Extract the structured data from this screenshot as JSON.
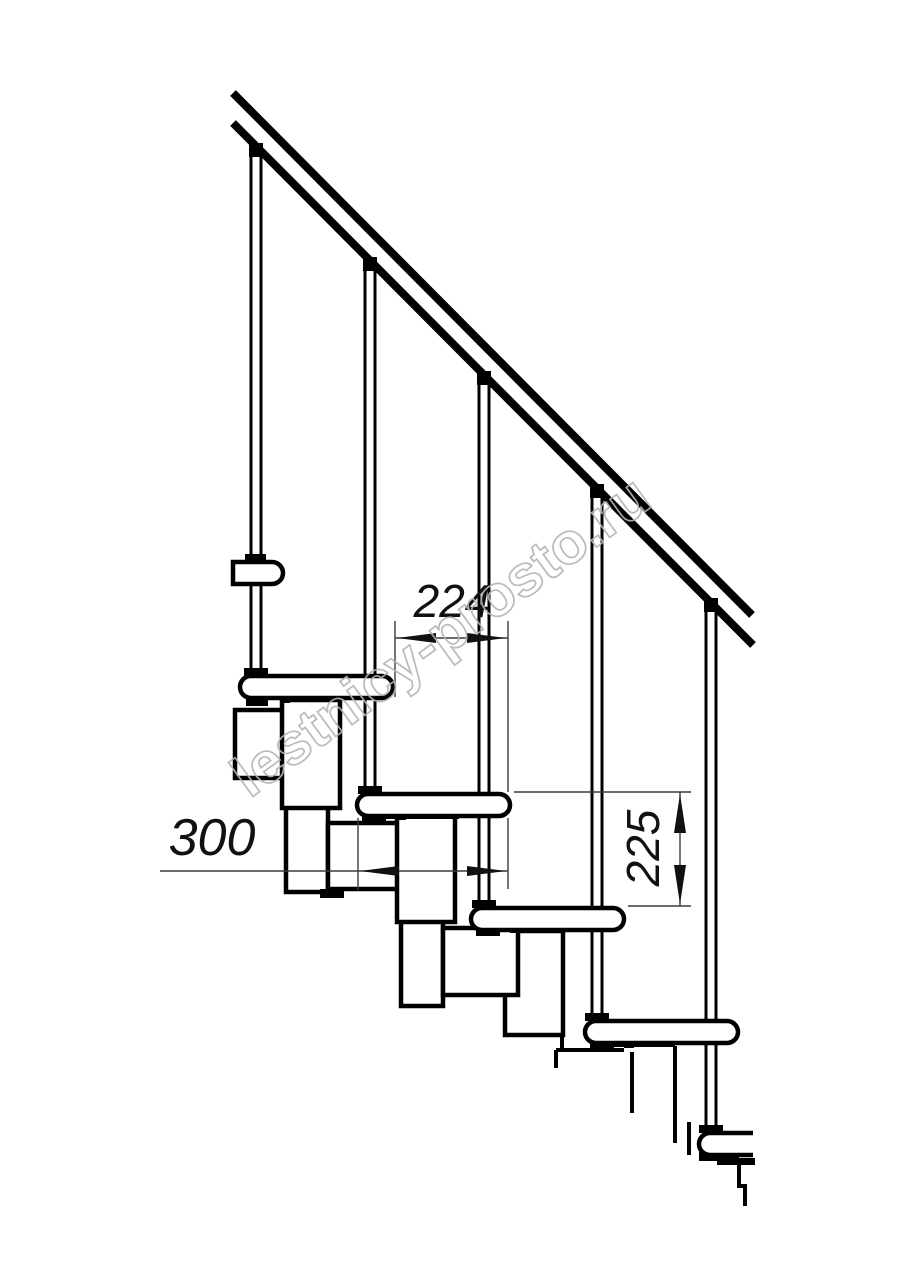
{
  "page": {
    "background": "#ffffff",
    "description": "Side-view technical drawing of a modular staircase with handrail, balusters, treads and step modules"
  },
  "watermark": {
    "text": "lestnicy-prosto.ru",
    "color": "#b4b4b4"
  },
  "dimensions": [
    {
      "name": "step-run",
      "label": "224",
      "orientation": "horizontal"
    },
    {
      "name": "tread-depth",
      "label": "300",
      "orientation": "horizontal"
    },
    {
      "name": "step-rise",
      "label": "225",
      "orientation": "vertical"
    }
  ],
  "colors": {
    "outline": "#000000",
    "dimension_lines": "#3c3c3c",
    "dimension_text": "#111111"
  }
}
